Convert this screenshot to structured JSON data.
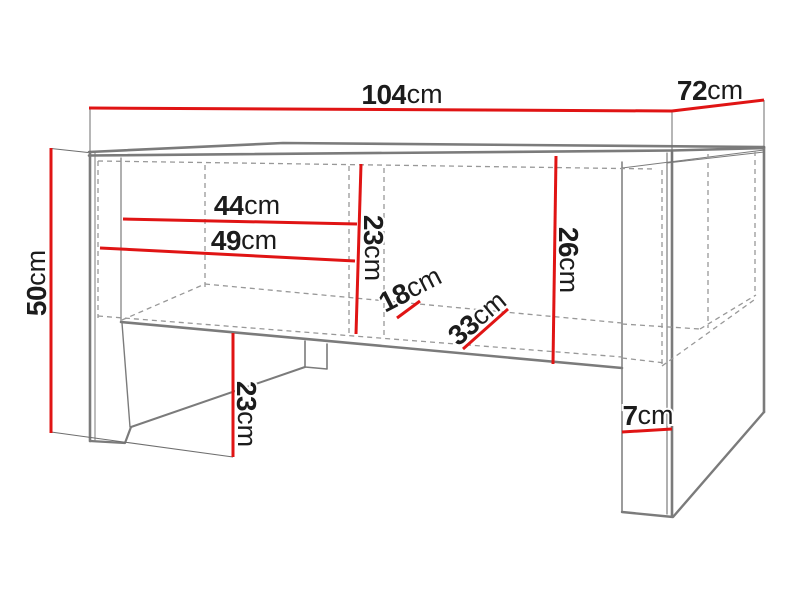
{
  "diagram": {
    "type": "furniture-dimension-drawing",
    "unit": "cm",
    "colors": {
      "dimension_red": "#e01414",
      "outline_grey": "#7b7b7b",
      "hidden_grey": "#989898",
      "extension_grey": "#6e6e6e",
      "text": "#1c1c1c",
      "background": "#ffffff"
    },
    "dimensions": [
      {
        "name": "top-width",
        "label": "104",
        "unit": "cm",
        "rotate": 0,
        "tx": 402,
        "ty": 94,
        "line": [
          [
            89,
            108
          ],
          [
            672,
            111
          ]
        ]
      },
      {
        "name": "top-depth",
        "label": "72",
        "unit": "cm",
        "rotate": 0,
        "tx": 710,
        "ty": 90,
        "line": [
          [
            672,
            111
          ],
          [
            764,
            100
          ]
        ]
      },
      {
        "name": "overall-height",
        "label": "50",
        "unit": "cm",
        "rotate": -90,
        "tx": 36,
        "ty": 283,
        "line": [
          [
            51,
            148
          ],
          [
            51,
            433
          ]
        ]
      },
      {
        "name": "inner-width-44",
        "label": "44",
        "unit": "cm",
        "rotate": 0,
        "tx": 247,
        "ty": 205,
        "line": [
          [
            123,
            219
          ],
          [
            357,
            224
          ]
        ]
      },
      {
        "name": "inner-width-49",
        "label": "49",
        "unit": "cm",
        "rotate": 0,
        "tx": 244,
        "ty": 240,
        "line": [
          [
            100,
            248
          ],
          [
            355,
            261
          ]
        ]
      },
      {
        "name": "inner-height-23",
        "label": "23",
        "unit": "cm",
        "rotate": 90,
        "tx": 374,
        "ty": 248,
        "line": [
          [
            361,
            164
          ],
          [
            356,
            334
          ]
        ]
      },
      {
        "name": "inner-height-26",
        "label": "26",
        "unit": "cm",
        "rotate": 90,
        "tx": 569,
        "ty": 260,
        "line": [
          [
            556,
            156
          ],
          [
            553,
            364
          ]
        ]
      },
      {
        "name": "shelf-depth-18",
        "label": "18",
        "unit": "cm",
        "rotate": -27,
        "tx": 410,
        "ty": 289,
        "line": [
          [
            397,
            318
          ],
          [
            420,
            301
          ]
        ]
      },
      {
        "name": "shelf-depth-33",
        "label": "33",
        "unit": "cm",
        "rotate": -40,
        "tx": 477,
        "ty": 318,
        "line": [
          [
            463,
            349
          ],
          [
            508,
            309
          ]
        ]
      },
      {
        "name": "leg-clearance-23",
        "label": "23",
        "unit": "cm",
        "rotate": 90,
        "tx": 247,
        "ty": 414,
        "line": [
          [
            233,
            333
          ],
          [
            233,
            457
          ]
        ]
      },
      {
        "name": "foot-height-7",
        "label": "7",
        "unit": "cm",
        "rotate": 0,
        "tx": 648,
        "ty": 415,
        "line": [
          [
            622,
            432
          ],
          [
            672,
            429
          ]
        ]
      }
    ]
  }
}
